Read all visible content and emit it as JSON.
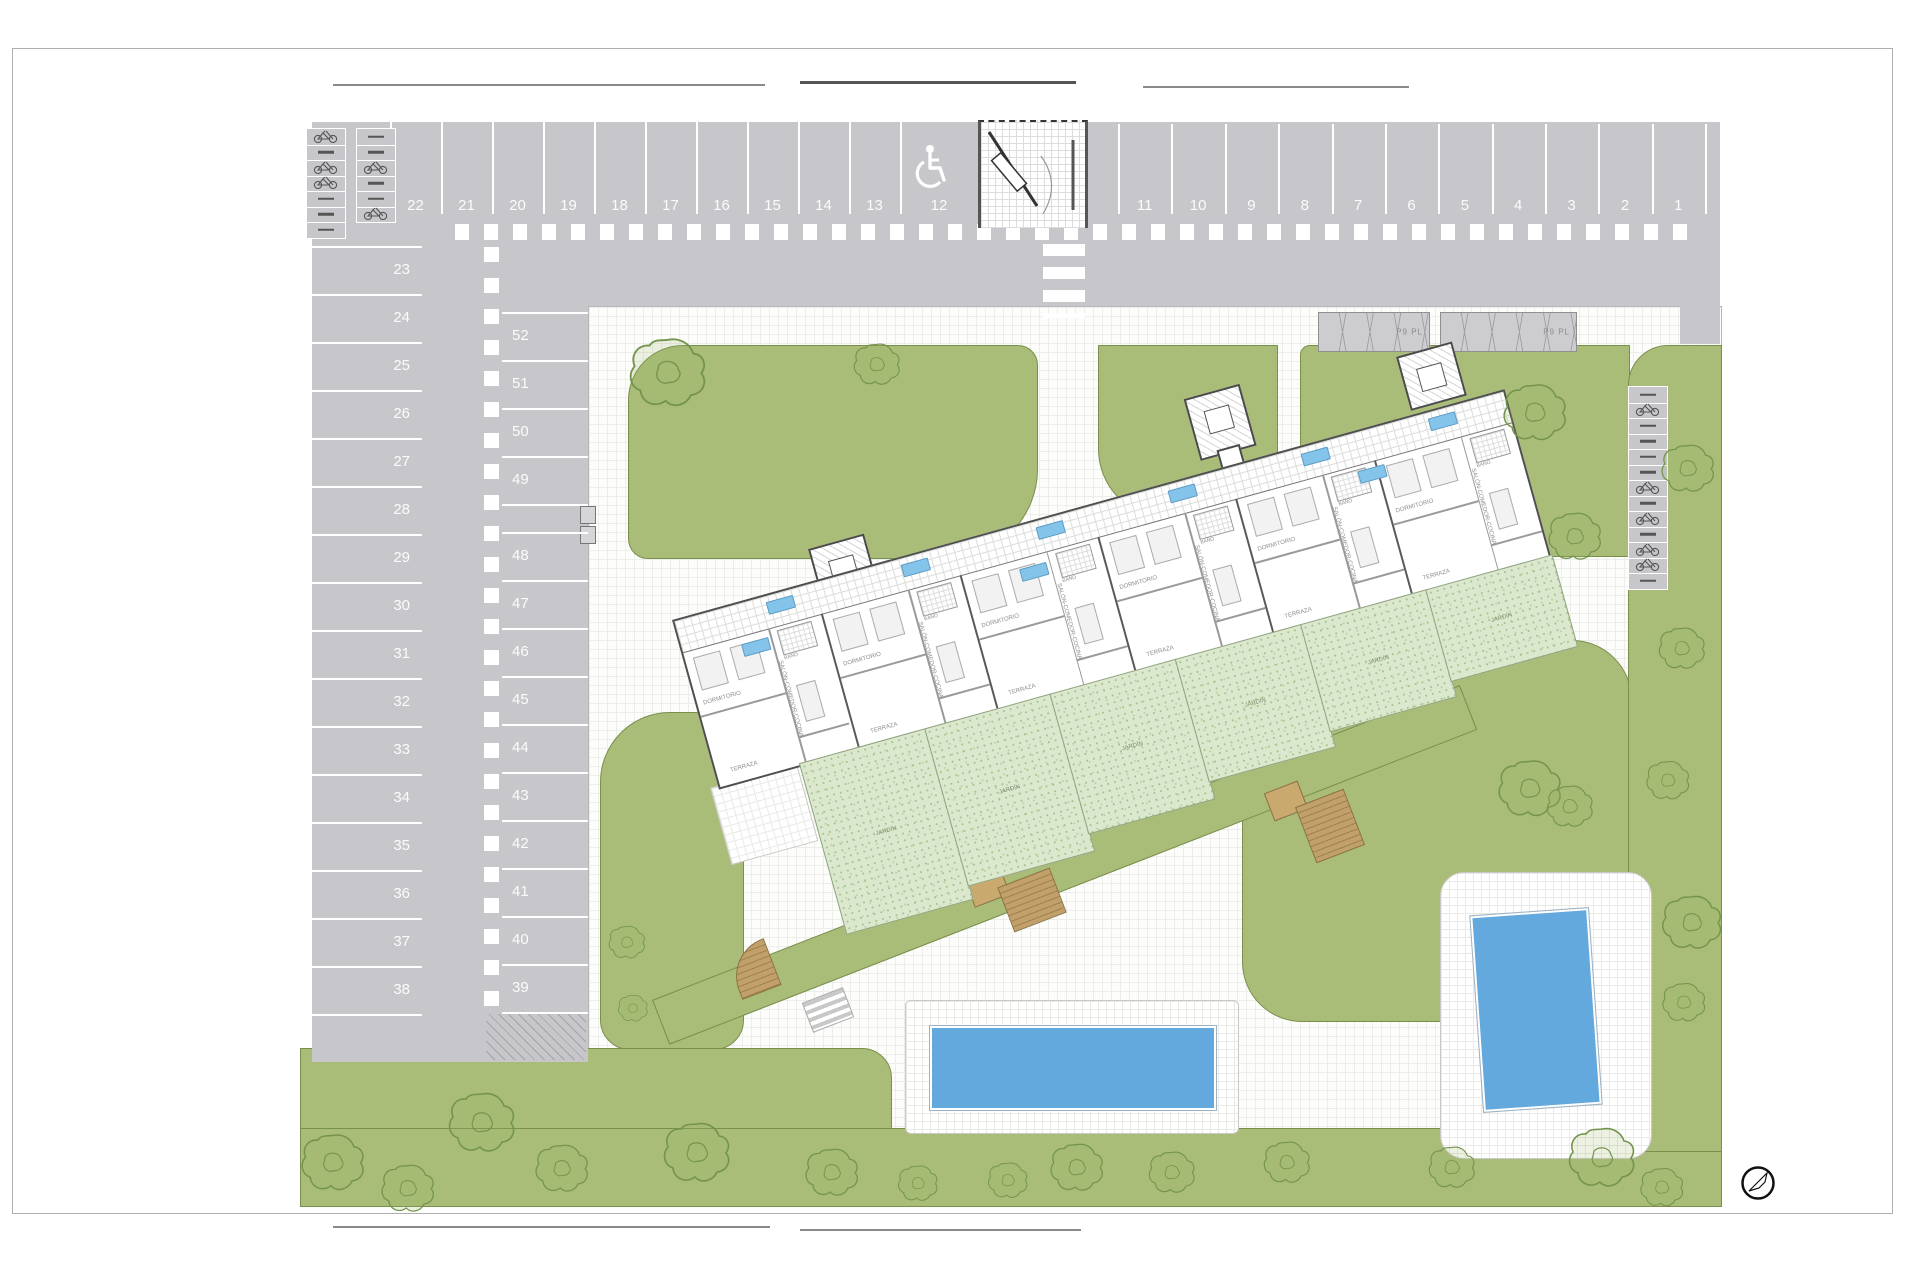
{
  "parking": {
    "top_row_left_numbers": [
      "22",
      "21",
      "20",
      "19",
      "18",
      "17",
      "16",
      "15",
      "14",
      "13"
    ],
    "handicap_space_number": "12",
    "top_row_right_numbers": [
      "11",
      "10",
      "9",
      "8",
      "7",
      "6",
      "5",
      "4",
      "3",
      "2",
      "1"
    ],
    "left_column_numbers": [
      "23",
      "24",
      "25",
      "26",
      "27",
      "28",
      "29",
      "30",
      "31",
      "32",
      "33",
      "34",
      "35",
      "36",
      "37",
      "38"
    ],
    "middle_column_upper_numbers": [
      "52",
      "51",
      "50",
      "49"
    ],
    "middle_column_lower_numbers": [
      "48",
      "47",
      "46",
      "45",
      "44",
      "43",
      "42",
      "41",
      "40",
      "39"
    ],
    "asphalt_color": "#c7c7cb",
    "marking_color": "#ffffff"
  },
  "pergolas": {
    "label": "P9 PL"
  },
  "building": {
    "unit_count": 6,
    "room_labels": {
      "living": "SALÓN-COMEDOR-COCINA",
      "bedroom": "DORMITORIO",
      "bath": "BAÑO",
      "terrace": "TERRAZA",
      "garden": "JARDÍN"
    },
    "badge_color": "#85c4ea"
  },
  "landscape": {
    "lawn_color": "#a9bc78",
    "private_garden_color": "#dbe8cd",
    "pool_color": "#64a9dd"
  }
}
